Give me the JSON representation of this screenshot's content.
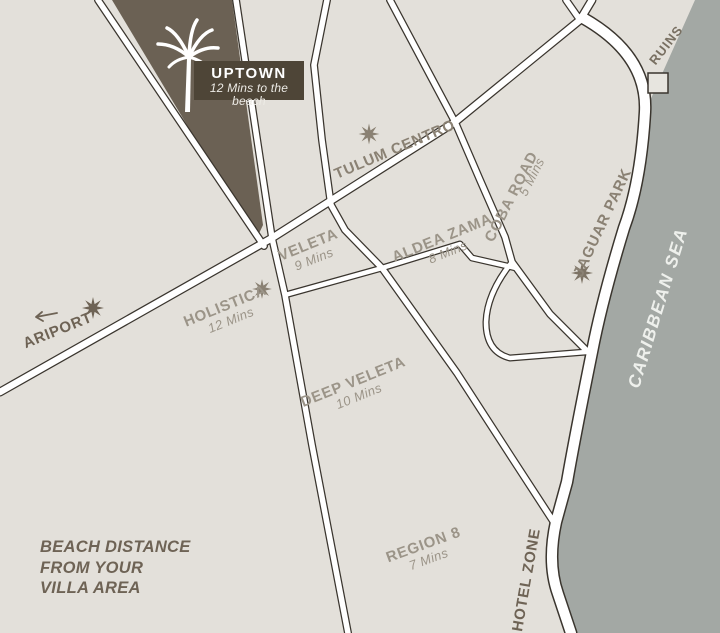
{
  "labels": {
    "uptown": {
      "name": "UPTOWN",
      "subtitle": "12 Mins to the beach"
    },
    "tulum_centro": {
      "name": "TULUM CENTRO"
    },
    "veleta": {
      "name": "VELETA",
      "minutes": "9 Mins"
    },
    "aldea_zama": {
      "name": "ALDEA ZAMA",
      "minutes": "8 Mins"
    },
    "coba_road": {
      "name": "COBA ROAD",
      "minutes": "5 Mins"
    },
    "jaguar_park": {
      "name": "JAGUAR PARK"
    },
    "holistica": {
      "name": "HOLISTICA",
      "minutes": "12 Mins"
    },
    "airport": {
      "name": "ARIPORT"
    },
    "deep_veleta": {
      "name": "DEEP VELETA",
      "minutes": "10 Mins"
    },
    "region_8": {
      "name": "REGION 8",
      "minutes": "7 Mins"
    },
    "hotel_zone": {
      "name": "HOTEL ZONE"
    },
    "ruins": {
      "name": "RUINS"
    },
    "sea": {
      "name": "CARIBBEAN SEA"
    }
  },
  "legend": {
    "line1": "BEACH DISTANCE",
    "line2": "FROM YOUR",
    "line3": "VILLA AREA"
  },
  "colors": {
    "land": "#e3e0da",
    "sea": "#a3a8a4",
    "road_fill": "#ffffff",
    "road_casing": "#3a352e",
    "uptown_area": "#6b6154",
    "uptown_box": "#4e4537",
    "label_light": "#9b9488",
    "label_mid": "#8a8173",
    "label_dark": "#6e6355"
  }
}
